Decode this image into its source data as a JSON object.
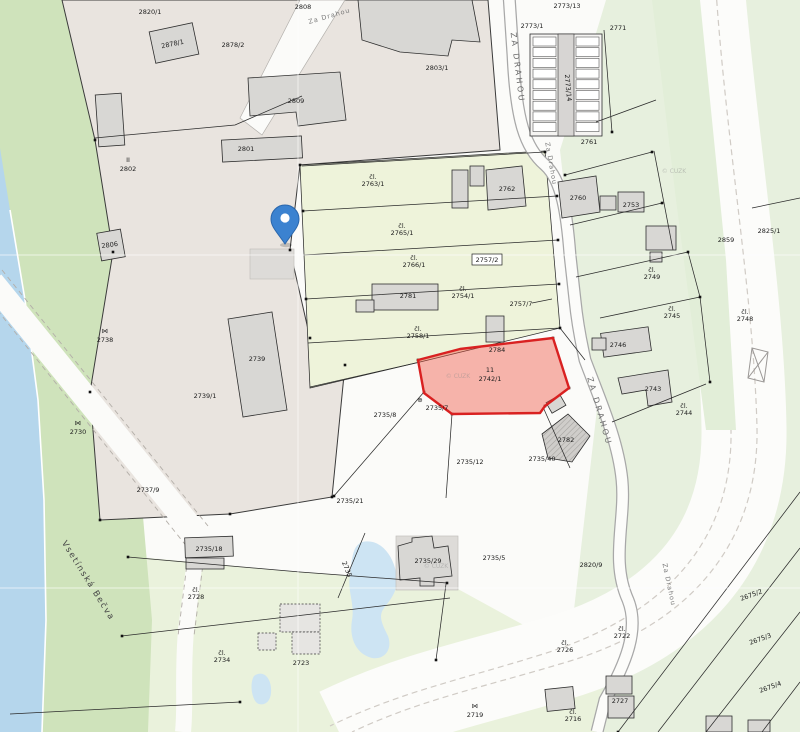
{
  "map": {
    "title": "Cadastral map with highlighted parcel",
    "streets": {
      "za_drahou_top": "Za Drahou",
      "za_drahou_upper": "ZA DRAHOU",
      "za_drahou_small": "Za Drahou",
      "za_drahou_mid": "ZA DRAHOU",
      "za_drahou_lower": "Za Drahou",
      "river": "Vsetínská Bečva"
    },
    "watermark": "© ČÚZK",
    "highlighted_parcel": {
      "number": "2742/1",
      "house_no": "11",
      "fill": "#ef4f3e",
      "stroke": "#d92121"
    },
    "pin": {
      "color": "#3b82d0",
      "inner": "#ffffff"
    },
    "colors": {
      "industrial_area": "#e9e4df",
      "strip_parcels": "#eef3da",
      "green_right": "#e7f0de",
      "green_left_band": "#cfe3bb",
      "green_bottom_left": "#eaf2dc",
      "river": "#b5d6ec",
      "pond": "#cde4f3",
      "building": "#d8d7d4",
      "road": "#fcfcfa"
    },
    "parcel_labels": [
      {
        "t": "2820/1",
        "x": 150,
        "y": 14
      },
      {
        "t": "2878/1",
        "x": 173,
        "y": 46,
        "r": -12,
        "s": 5
      },
      {
        "t": "2878/2",
        "x": 233,
        "y": 47,
        "s": 5.5
      },
      {
        "t": "2808",
        "x": 303,
        "y": 9,
        "s": 5.5
      },
      {
        "t": "2809",
        "x": 296,
        "y": 103
      },
      {
        "t": "2803/1",
        "x": 437,
        "y": 70
      },
      {
        "t": "II",
        "x": 128,
        "y": 162,
        "s": 5
      },
      {
        "t": "2802",
        "x": 128,
        "y": 171
      },
      {
        "t": "2801",
        "x": 246,
        "y": 151,
        "s": 5.5
      },
      {
        "t": "2806",
        "x": 110,
        "y": 247,
        "r": -8,
        "s": 5
      },
      {
        "t": "2773/13",
        "x": 567,
        "y": 8,
        "s": 5.5
      },
      {
        "t": "2773/1",
        "x": 532,
        "y": 28,
        "s": 5.5
      },
      {
        "t": "2773/14",
        "x": 566,
        "y": 88,
        "r": 85,
        "s": 5
      },
      {
        "t": "2771",
        "x": 618,
        "y": 30,
        "s": 5.5
      },
      {
        "t": "2761",
        "x": 589,
        "y": 144,
        "s": 5.5
      },
      {
        "t": "2762",
        "x": 507,
        "y": 191,
        "s": 5.5
      },
      {
        "t": "2760",
        "x": 578,
        "y": 200,
        "s": 5
      },
      {
        "t": "2753",
        "x": 631,
        "y": 207,
        "s": 5.5
      },
      {
        "t": "2825/1",
        "x": 769,
        "y": 233
      },
      {
        "t": "2859",
        "x": 726,
        "y": 242
      },
      {
        "t": "čl.",
        "l2": "2763/1",
        "x": 373,
        "y": 179
      },
      {
        "t": "čl.",
        "l2": "2765/1",
        "x": 402,
        "y": 228
      },
      {
        "t": "čl.",
        "l2": "2766/1",
        "x": 414,
        "y": 260
      },
      {
        "t": "čl.",
        "l2": "2754/1",
        "x": 463,
        "y": 291
      },
      {
        "t": "2757/2",
        "x": 487,
        "y": 262,
        "box": true,
        "s": 5.5
      },
      {
        "t": "2757/7",
        "x": 521,
        "y": 306,
        "s": 5.5
      },
      {
        "t": "čl.",
        "l2": "2758/1",
        "x": 418,
        "y": 331
      },
      {
        "t": "2781",
        "x": 408,
        "y": 298,
        "s": 5.5
      },
      {
        "t": "2784",
        "x": 497,
        "y": 352,
        "s": 5
      },
      {
        "t": "čl.",
        "l2": "2749",
        "x": 652,
        "y": 272
      },
      {
        "t": "čl.",
        "l2": "2745",
        "x": 672,
        "y": 311
      },
      {
        "t": "2746",
        "x": 618,
        "y": 347,
        "s": 5.5
      },
      {
        "t": "2743",
        "x": 653,
        "y": 391,
        "s": 5.5
      },
      {
        "t": "čl.",
        "l2": "2744",
        "x": 684,
        "y": 408
      },
      {
        "t": "čl.",
        "l2": "2748",
        "x": 745,
        "y": 314
      },
      {
        "t": "⋈",
        "x": 105,
        "y": 333,
        "s": 5
      },
      {
        "t": "2738",
        "x": 105,
        "y": 342
      },
      {
        "t": "⋈",
        "x": 78,
        "y": 425,
        "s": 5
      },
      {
        "t": "2730",
        "x": 78,
        "y": 434
      },
      {
        "t": "2737/9",
        "x": 148,
        "y": 492,
        "s": 5.5
      },
      {
        "t": "2739",
        "x": 257,
        "y": 361,
        "s": 5.5
      },
      {
        "t": "2739/1",
        "x": 205,
        "y": 398
      },
      {
        "t": "2735/18",
        "x": 209,
        "y": 551,
        "s": 5.5
      },
      {
        "t": "2735/21",
        "x": 350,
        "y": 503,
        "s": 5.5
      },
      {
        "t": "2735/8",
        "x": 385,
        "y": 417,
        "s": 5.5
      },
      {
        "t": "⊕",
        "x": 420,
        "y": 402,
        "s": 5
      },
      {
        "t": "2735/7",
        "x": 437,
        "y": 410,
        "s": 5.5
      },
      {
        "t": "2735/12",
        "x": 470,
        "y": 464,
        "s": 5.5
      },
      {
        "t": "2735/40",
        "x": 542,
        "y": 461,
        "s": 5.5
      },
      {
        "t": "2782",
        "x": 566,
        "y": 442,
        "s": 5.5
      },
      {
        "t": "2735/29",
        "x": 428,
        "y": 563,
        "s": 5.5
      },
      {
        "t": "2735/5",
        "x": 494,
        "y": 560,
        "s": 5.5
      },
      {
        "t": "2735",
        "x": 345,
        "y": 570,
        "r": 68,
        "s": 5.5
      },
      {
        "t": "2820/9",
        "x": 591,
        "y": 567,
        "s": 5.5
      },
      {
        "t": "čl.",
        "l2": "2728",
        "x": 196,
        "y": 592
      },
      {
        "t": "čl.",
        "l2": "2734",
        "x": 222,
        "y": 655
      },
      {
        "t": "2723",
        "x": 301,
        "y": 665,
        "s": 5.5
      },
      {
        "t": "⋈",
        "x": 475,
        "y": 708,
        "s": 5
      },
      {
        "t": "2719",
        "x": 475,
        "y": 717
      },
      {
        "t": "čl.",
        "l2": "2726",
        "x": 565,
        "y": 645
      },
      {
        "t": "čl.",
        "l2": "2722",
        "x": 622,
        "y": 631
      },
      {
        "t": "2727",
        "x": 620,
        "y": 703,
        "s": 5.5
      },
      {
        "t": "čl.",
        "l2": "2716",
        "x": 573,
        "y": 714,
        "s": 5.5
      },
      {
        "t": "2675/2",
        "x": 752,
        "y": 597,
        "r": -20,
        "s": 5.5
      },
      {
        "t": "2675/3",
        "x": 761,
        "y": 641,
        "r": -20,
        "s": 5.5
      },
      {
        "t": "2675/4",
        "x": 771,
        "y": 689,
        "r": -20,
        "s": 5.5
      }
    ]
  }
}
